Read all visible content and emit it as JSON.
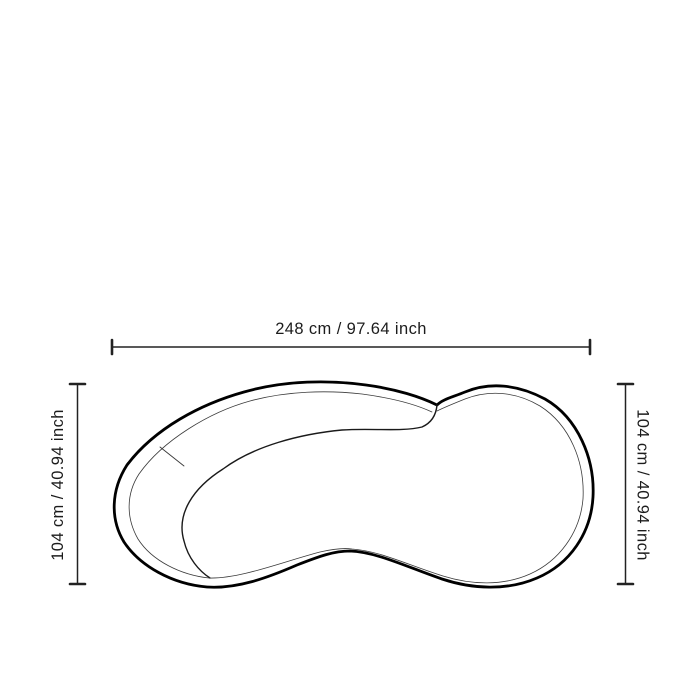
{
  "colors": {
    "ink": "#1c1c1c",
    "line": "#222222",
    "background": "#ffffff"
  },
  "diagram": {
    "width_label": "248 cm / 97.64 inch",
    "height_left_label": "104 cm / 40.94 inch",
    "height_right_label": "104 cm / 40.94 inch"
  }
}
